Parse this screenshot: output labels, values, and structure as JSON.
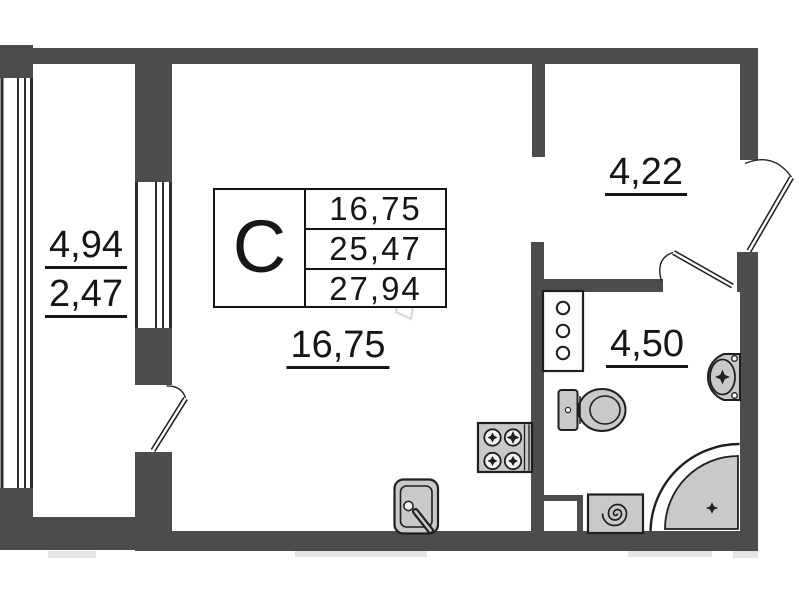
{
  "plan": {
    "title_block": {
      "section_letter": "C",
      "values": [
        "16,75",
        "25,47",
        "27,94"
      ]
    },
    "rooms": {
      "balcony": {
        "area": "4,94",
        "area_reduced": "2,47"
      },
      "living": {
        "area": "16,75"
      },
      "hallway": {
        "area": "4,22"
      },
      "bathroom": {
        "area": "4,50"
      }
    },
    "colors": {
      "wall": "#4c4c4e",
      "fixture_fill": "#c9c9c9",
      "line": "#1f1f1f",
      "background": "#ffffff",
      "watermark": "#dcdcdc"
    },
    "fixtures": [
      "ventilation-shaft",
      "toilet",
      "washbasin",
      "corner-shower",
      "washing-machine",
      "stove",
      "kitchen-sink"
    ]
  }
}
